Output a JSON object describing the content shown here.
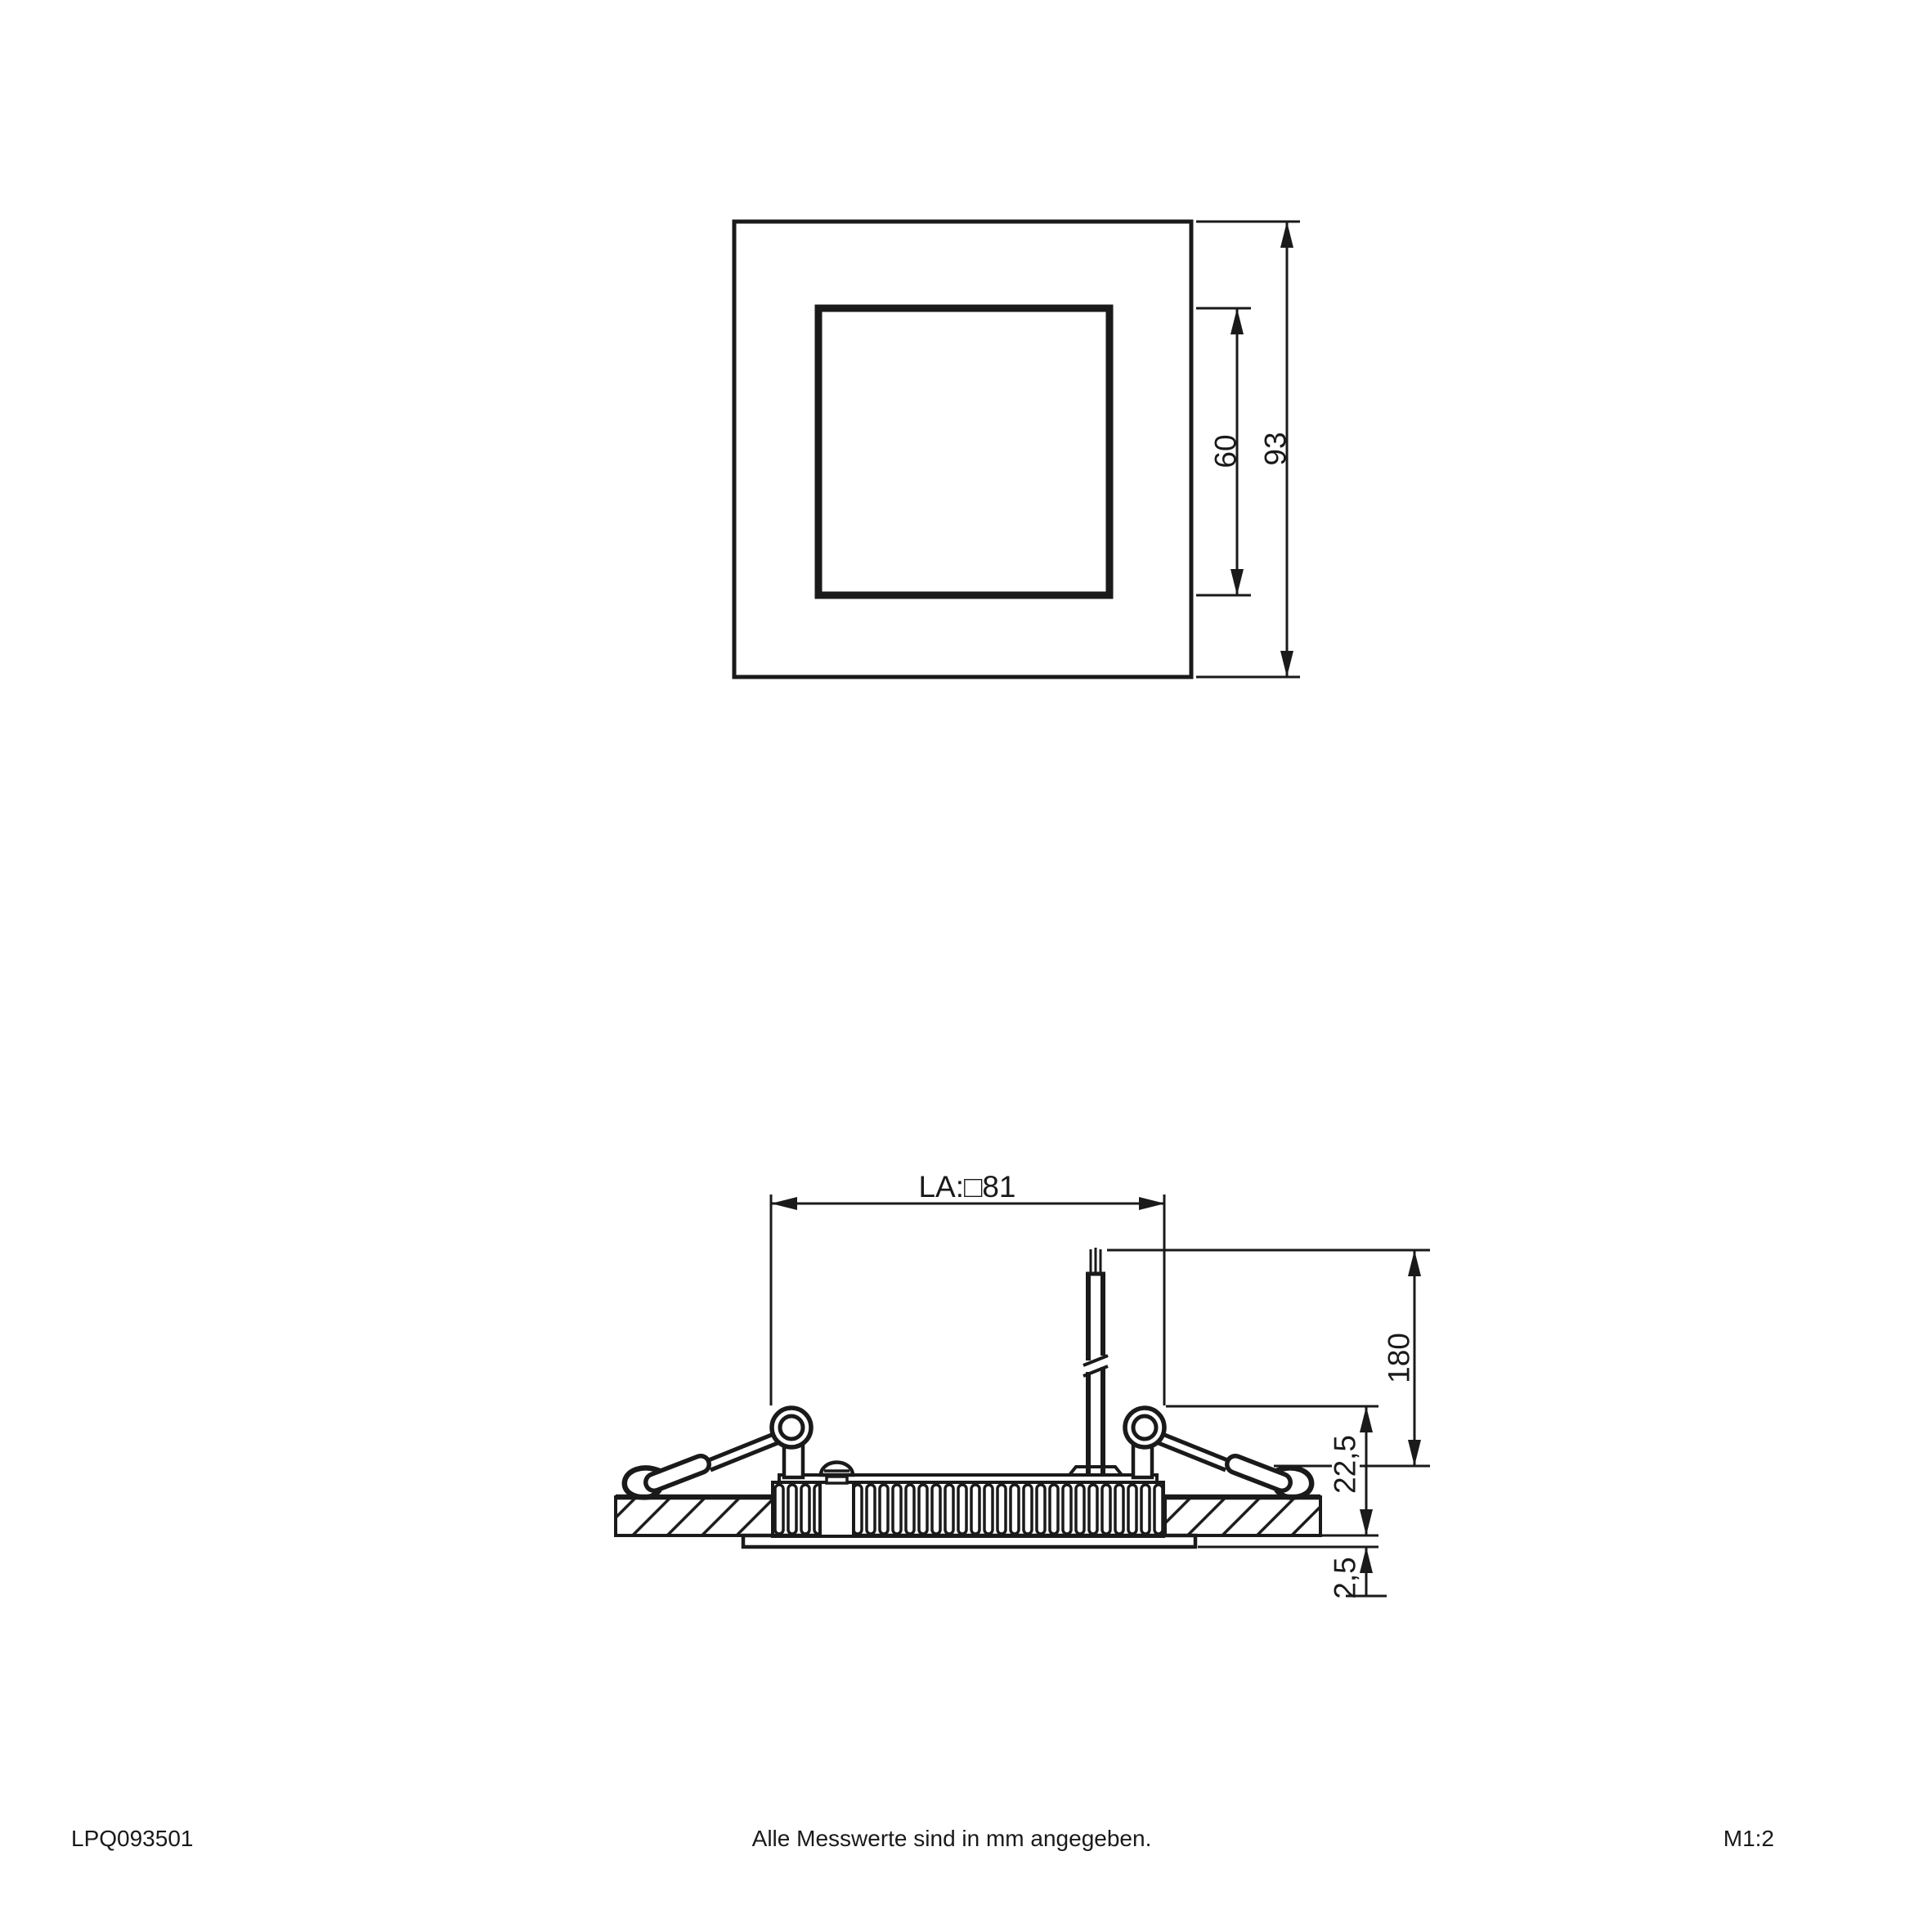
{
  "drawing": {
    "product_code": "LPQ093501",
    "note": "Alle Messwerte sind in mm angegeben.",
    "scale": "M1:2",
    "top_view": {
      "inner_size": "60",
      "outer_size": "93"
    },
    "side_view": {
      "cutout": "LA:□81",
      "cable_length": "180",
      "recess_height": "22,5",
      "rim_height": "2,5"
    }
  },
  "colors": {
    "line": "#1a1a1a",
    "background": "#ffffff"
  }
}
